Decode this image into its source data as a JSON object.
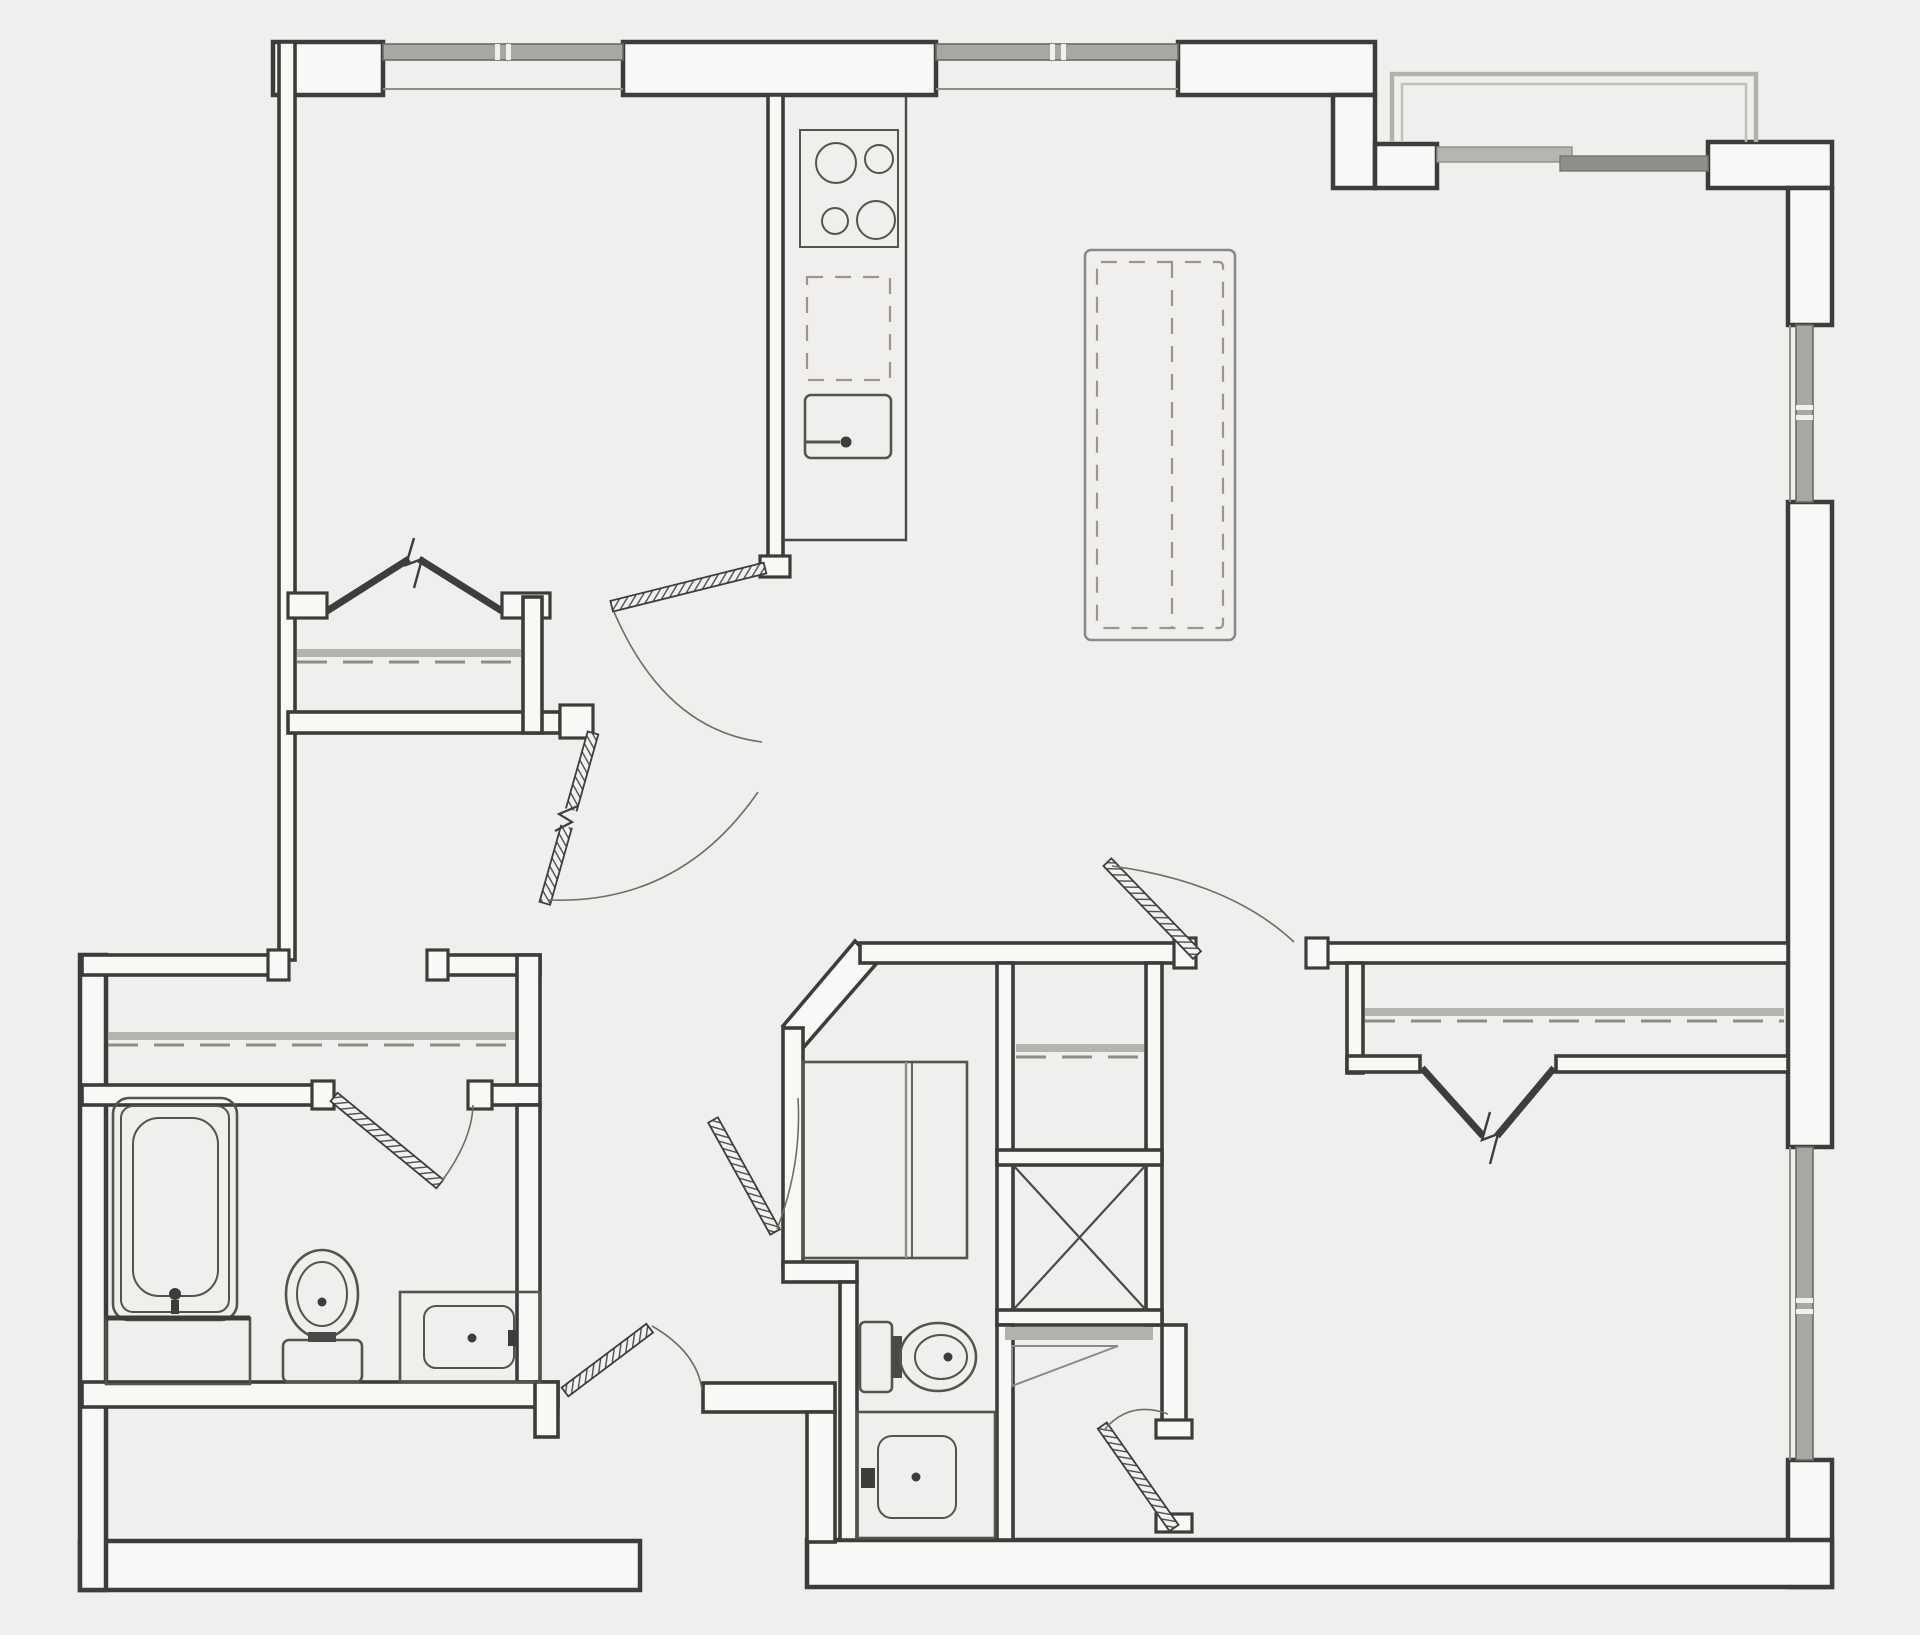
{
  "document": {
    "type": "architectural-floor-plan",
    "style": "black-and-white line drawing, top-down 2D plan",
    "visible_text": [],
    "background_color": "#f0efed"
  },
  "colors": {
    "background": "#f0efed",
    "wall_line": "#3d3c3a",
    "wall_fill": "#f9f8f6",
    "fixture_line": "#55534f",
    "glass_dark": "#8f8e8b",
    "glass_light": "#b7b5b2",
    "closet_rod_gray": "#b5b3b0",
    "balcony_outline": "#b3b1ae"
  },
  "rooms": [
    {
      "id": "bedroom-1",
      "position": "top-left",
      "features": [
        "window-north",
        "built-in-closet-with-rod",
        "double-closet-doors"
      ]
    },
    {
      "id": "kitchen",
      "position": "top-center",
      "features": [
        "counter-run",
        "cooktop-4-burners",
        "dishwasher-dashed",
        "kitchen-sink",
        "swing-door"
      ]
    },
    {
      "id": "living-dining-room",
      "position": "top-right",
      "features": [
        "kitchen-island-dashed",
        "balcony-access-glass-door",
        "window-east"
      ]
    },
    {
      "id": "balcony",
      "position": "top-right-exterior",
      "features": [
        "open-outline"
      ]
    },
    {
      "id": "hallway",
      "position": "center",
      "features": [
        "door-swings"
      ]
    },
    {
      "id": "walk-in-closet",
      "position": "left-middle",
      "features": [
        "closet-rod"
      ]
    },
    {
      "id": "bathroom-1",
      "position": "bottom-left",
      "features": [
        "bathtub",
        "toilet",
        "vanity-sink",
        "swing-door"
      ]
    },
    {
      "id": "bathroom-2",
      "position": "bottom-center",
      "features": [
        "shower-with-glass-panel",
        "toilet",
        "vanity-sink",
        "angled-entry-door"
      ]
    },
    {
      "id": "linen-closet",
      "position": "center",
      "features": [
        "closet-rod"
      ]
    },
    {
      "id": "utility-shaft",
      "position": "center",
      "features": [
        "x-cross-symbol",
        "access-panel"
      ]
    },
    {
      "id": "bedroom-2",
      "position": "bottom-right",
      "features": [
        "window-east",
        "closet-with-rod",
        "double-closet-doors",
        "two-swing-doors"
      ]
    },
    {
      "id": "entry",
      "position": "bottom-center-left",
      "features": [
        "recessed-alcove",
        "entry-door"
      ]
    }
  ],
  "fixtures": [
    {
      "id": "cooktop",
      "burners": 4
    },
    {
      "id": "dishwasher",
      "style": "dashed-outline"
    },
    {
      "id": "kitchen-sink",
      "has_faucet": true
    },
    {
      "id": "kitchen-island",
      "style": "dashed-inner-outline"
    },
    {
      "id": "bathtub",
      "nested_outlines": 3,
      "has_faucet": true
    },
    {
      "id": "tub-deck"
    },
    {
      "id": "toilet-1"
    },
    {
      "id": "vanity-sink-1"
    },
    {
      "id": "shower-stall",
      "glass_partition": true
    },
    {
      "id": "toilet-2"
    },
    {
      "id": "vanity-sink-2"
    },
    {
      "id": "utility-shaft-x-box"
    },
    {
      "id": "closet-rods",
      "count": 4
    }
  ],
  "windows": [
    {
      "id": "window-north-bedroom-1",
      "wall": "north"
    },
    {
      "id": "window-north-living",
      "wall": "north"
    },
    {
      "id": "balcony-glass-door",
      "wall": "north-east-step"
    },
    {
      "id": "window-east-living",
      "wall": "east"
    },
    {
      "id": "window-east-bedroom-2",
      "wall": "east"
    }
  ],
  "doors": [
    {
      "id": "bedroom-1-door",
      "type": "swing",
      "symbol": "hatched-leaf-with-break"
    },
    {
      "id": "kitchen-door",
      "type": "swing",
      "symbol": "hatched-leaf"
    },
    {
      "id": "bedroom-1-closet-doors",
      "type": "double-hinged",
      "symbol": "solid-v-leaves"
    },
    {
      "id": "bathroom-1-door",
      "type": "swing",
      "symbol": "hatched-leaf"
    },
    {
      "id": "bathroom-2-door",
      "type": "swing-on-chamfer",
      "symbol": "hatched-leaf"
    },
    {
      "id": "entry-door",
      "type": "swing",
      "symbol": "hatched-leaf"
    },
    {
      "id": "bedroom-2-door-north",
      "type": "swing",
      "symbol": "hatched-leaf"
    },
    {
      "id": "bedroom-2-door-south",
      "type": "swing",
      "symbol": "hatched-leaf"
    },
    {
      "id": "bedroom-2-closet-doors",
      "type": "double-hinged",
      "symbol": "solid-v-leaves"
    }
  ]
}
